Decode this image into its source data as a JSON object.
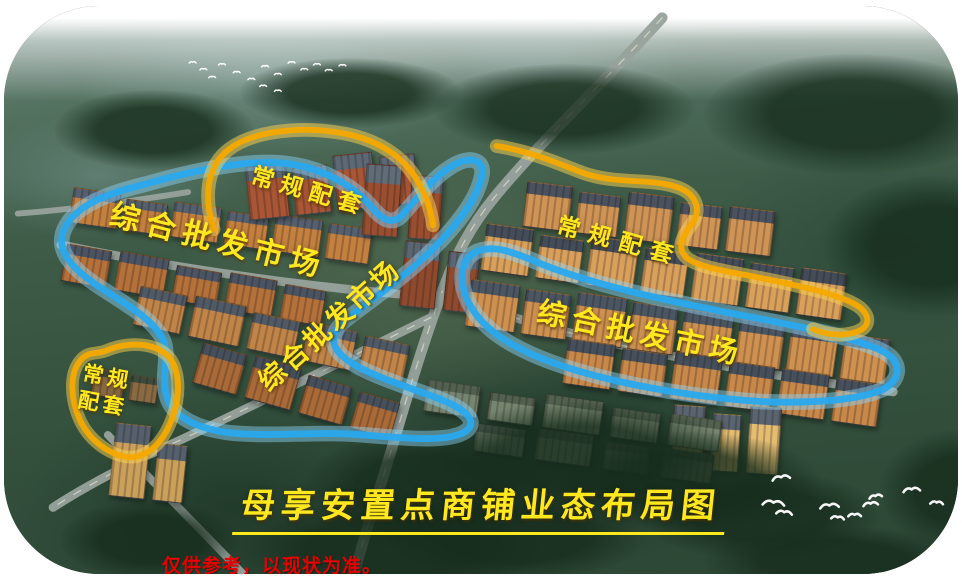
{
  "scene": {
    "title": "母享安置点商铺业态布局图",
    "disclaimer": "仅供参考，以现状为准。",
    "labels": {
      "top_support": "常规配套",
      "left_market": "综合批发市场",
      "center_market": "综合批发市场",
      "right_support": "常规配套",
      "right_market": "综合批发市场",
      "bottomleft_support_line1": "常规",
      "bottomleft_support_line2": "配套"
    },
    "colors": {
      "market_outline_blue": "#29a9ee",
      "support_outline_yellow": "#f5a800",
      "label_text_yellow": "#ffe81e",
      "disclaimer_red": "#e60000"
    }
  }
}
